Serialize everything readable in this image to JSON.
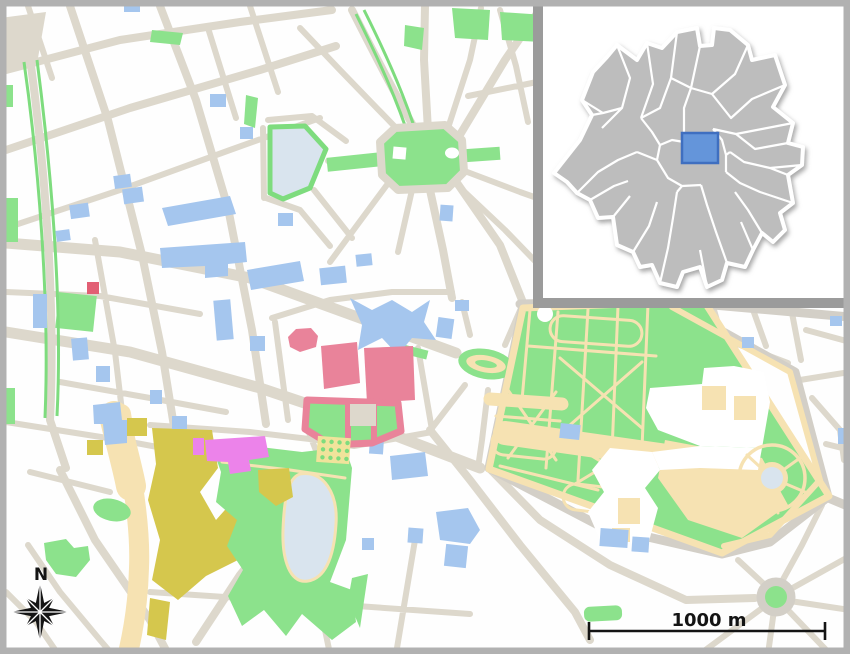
{
  "map": {
    "type": "city-street-map-with-locator-inset",
    "compass": {
      "label": "N",
      "icon": "compass-rose-8-point-star"
    },
    "scale_bar": {
      "label": "1000 m"
    },
    "inset": {
      "purpose": "region-locator",
      "region_fill": "#bdbdbd",
      "boundary_color": "#ffffff",
      "highlight_fill": "#6495da",
      "highlight_stroke": "#3f6fc0",
      "border_color": "#9b9b9b",
      "background": "#ffffff"
    },
    "colors": {
      "street": "#ddd8cc",
      "road2": "#d3cfc7",
      "green": "#8ce28c",
      "green2": "#7edc7e",
      "water": "#d9e4ee",
      "blue": "#a5c6ee",
      "pink": "#e9839a",
      "red": "#e25f74",
      "magenta": "#ec83ea",
      "olive": "#d5c74d",
      "path": "#f6e2b2",
      "garden": "#f0e39b",
      "ink": "#141414",
      "frame": "#b1b1b1"
    }
  }
}
